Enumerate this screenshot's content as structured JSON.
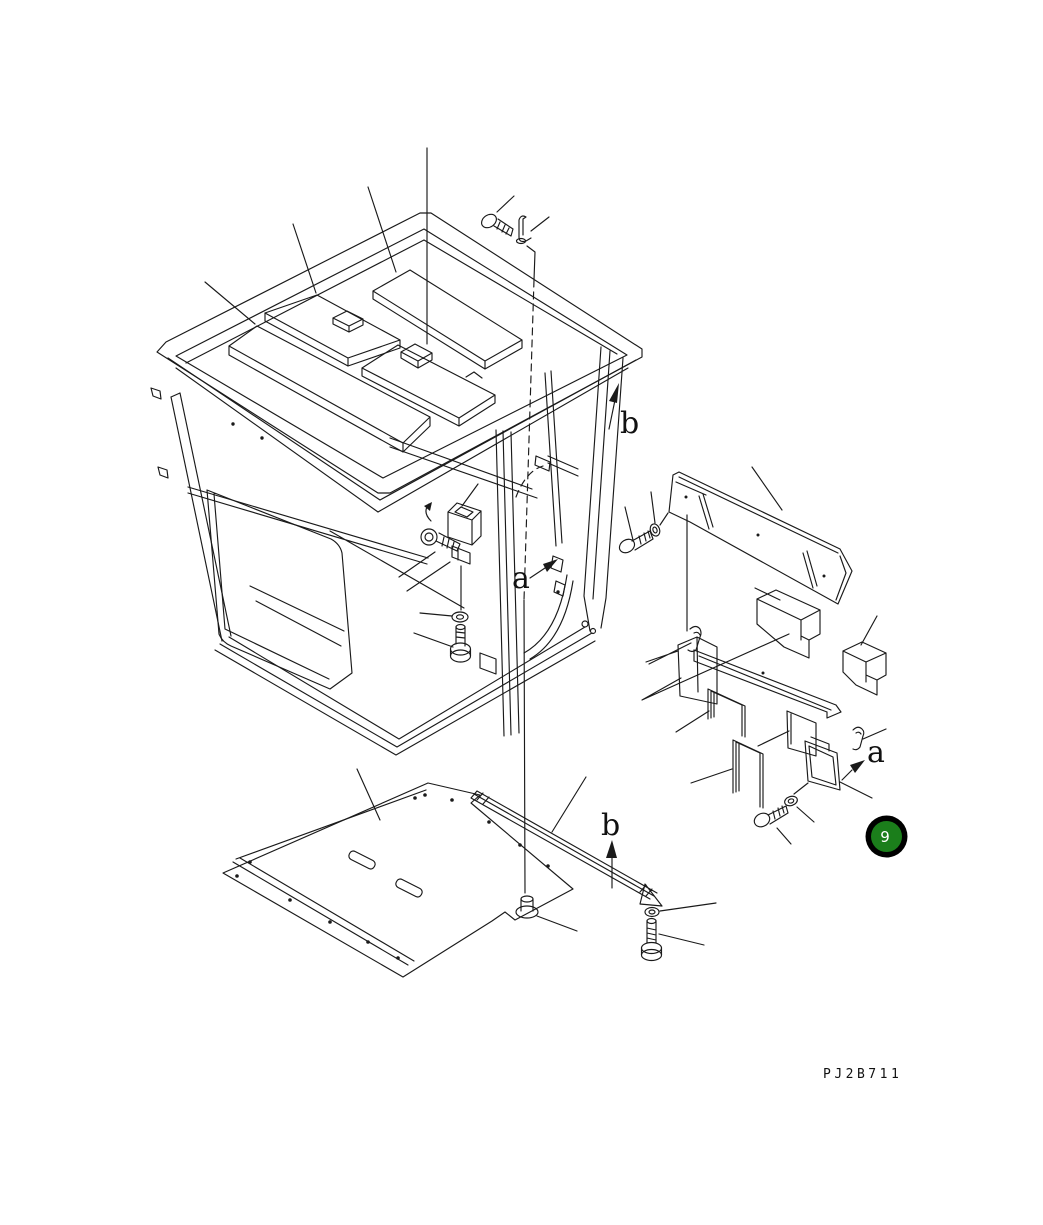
{
  "page": {
    "background_color": "#ffffff",
    "line_color": "#1a1a1a"
  },
  "view_labels": {
    "b_top": "b",
    "a_cab": "a",
    "a_panel": "a",
    "b_floor": "b"
  },
  "callout": {
    "number": "9",
    "fill_color": "#1b7e1b",
    "ring_color": "#000000",
    "text_color": "#ffffff"
  },
  "footer": {
    "drawing_code": "PJ2B711"
  }
}
